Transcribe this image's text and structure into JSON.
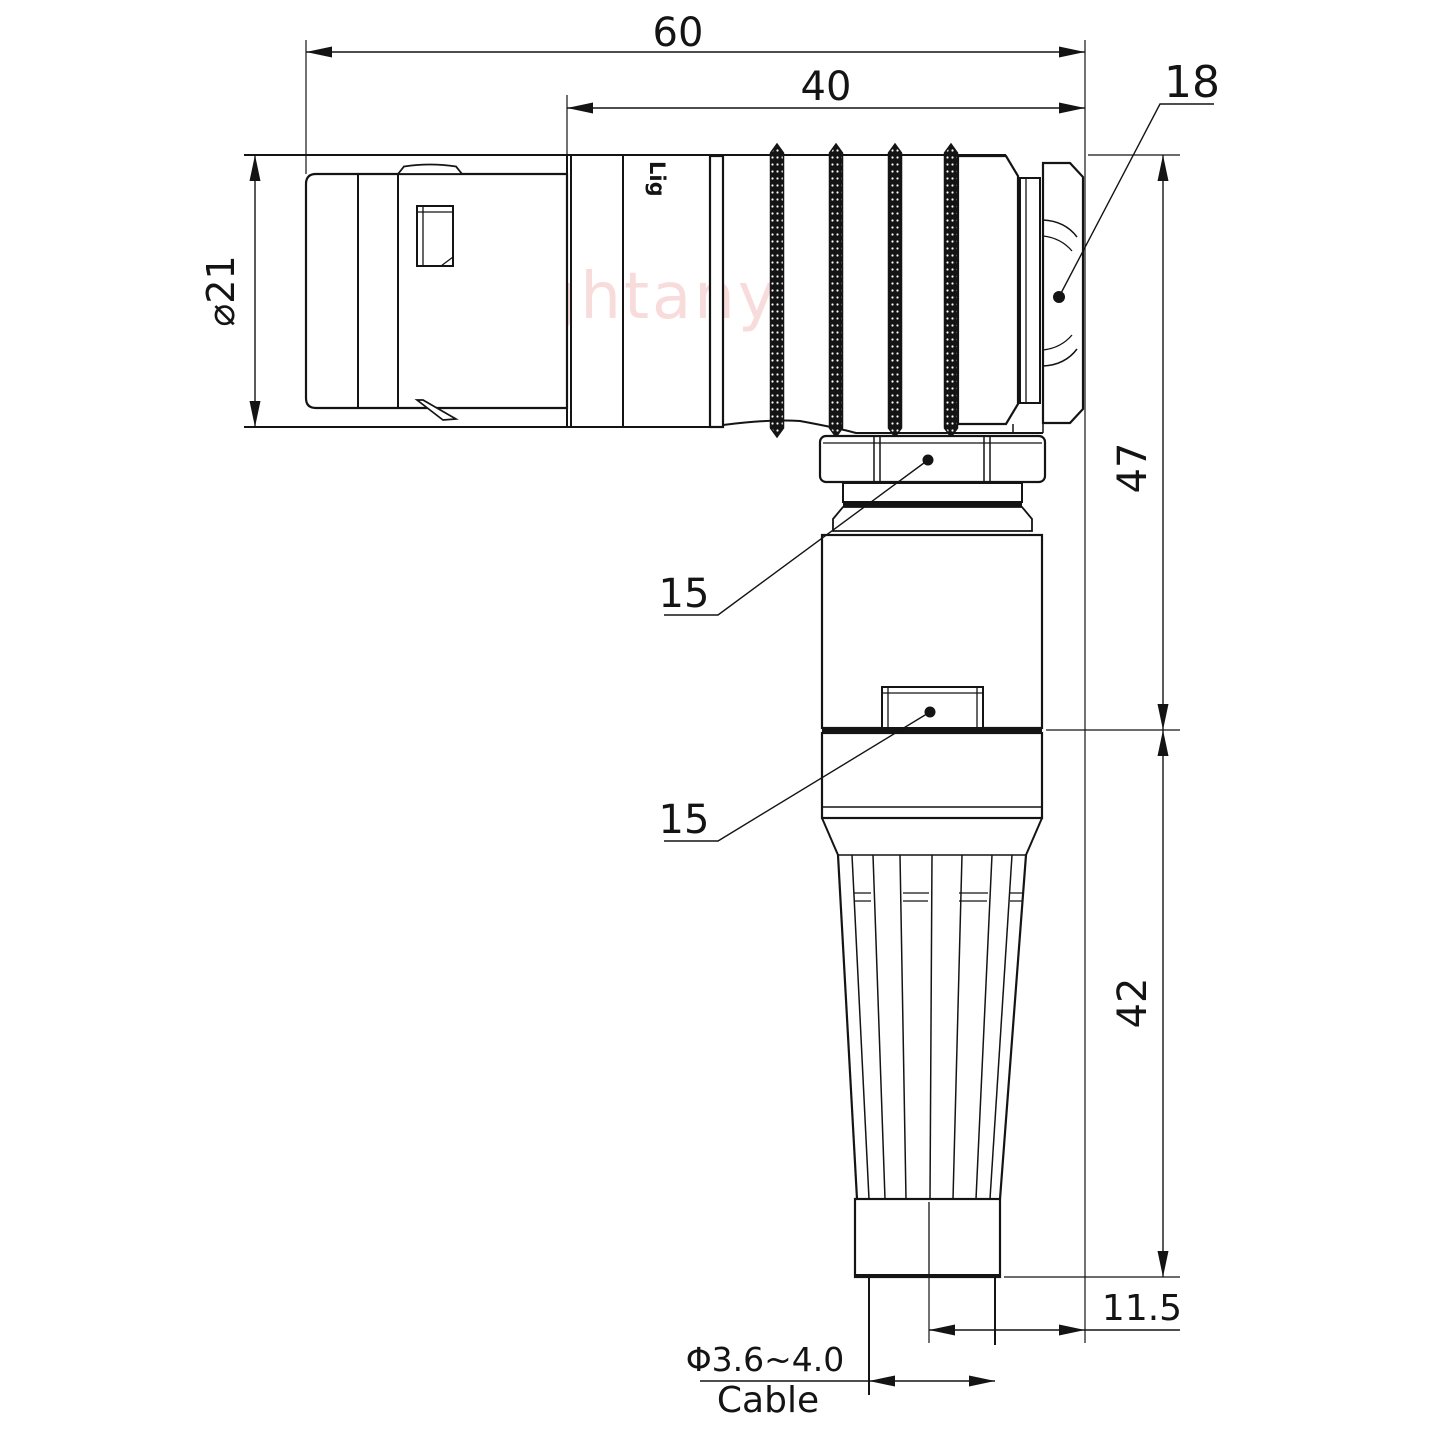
{
  "watermark": "Lightany",
  "part_marking": "Lig",
  "dimensions": {
    "overall_length": "60",
    "rear_section_length": "40",
    "shell_diameter": "⌀21",
    "height_upper": "47",
    "height_lower": "42",
    "axis_to_nut_face": "11.5",
    "cable_diameter": "Φ3.6~4.0",
    "cable_label": "Cable",
    "nut_callout": "18",
    "collet_callout": "15",
    "window_callout": "15"
  }
}
